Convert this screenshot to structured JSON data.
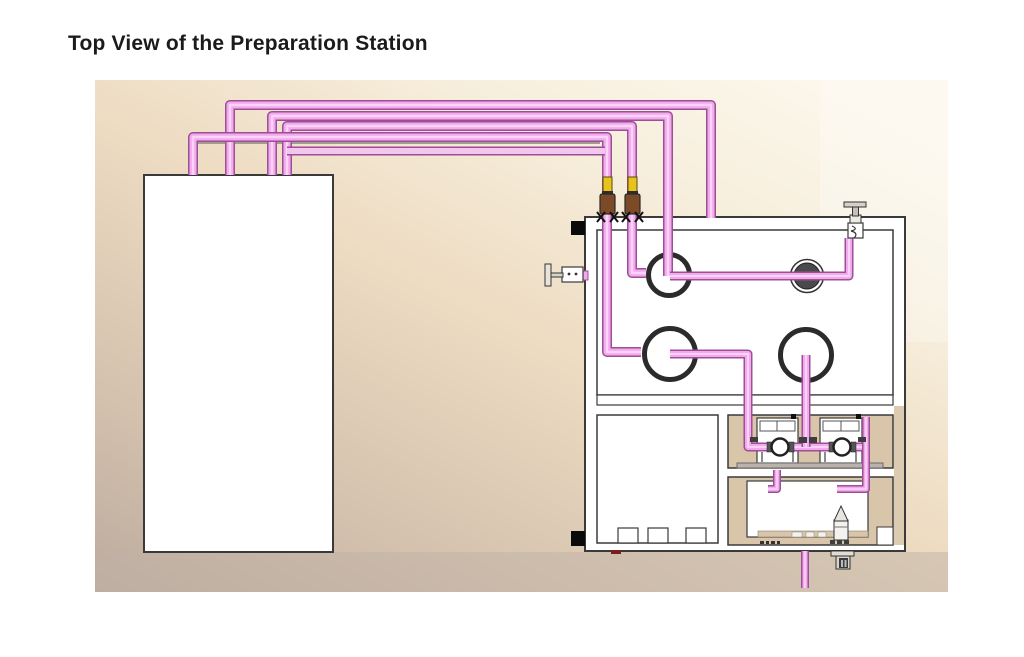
{
  "title": "Top View of the Preparation Station",
  "colors": {
    "background_top": "#fcf7ec",
    "background_mid": "#eedcc3",
    "background_bottom": "#bcab9e",
    "pipe_fill": "#f2a9ee",
    "pipe_border": "#9c4f94",
    "pipe_highlight": "#fbdcf8",
    "pipe_light_fill": "#f3c6ef",
    "valve_yellow": "#e7c31c",
    "valve_brown": "#7d4a28",
    "ring_dark": "#2b2b2b",
    "disk_gray": "#4a4a4a",
    "panel_tan": "#d9c5a9",
    "outline": "#3a3a3a",
    "title_color": "#1b1b1b"
  }
}
